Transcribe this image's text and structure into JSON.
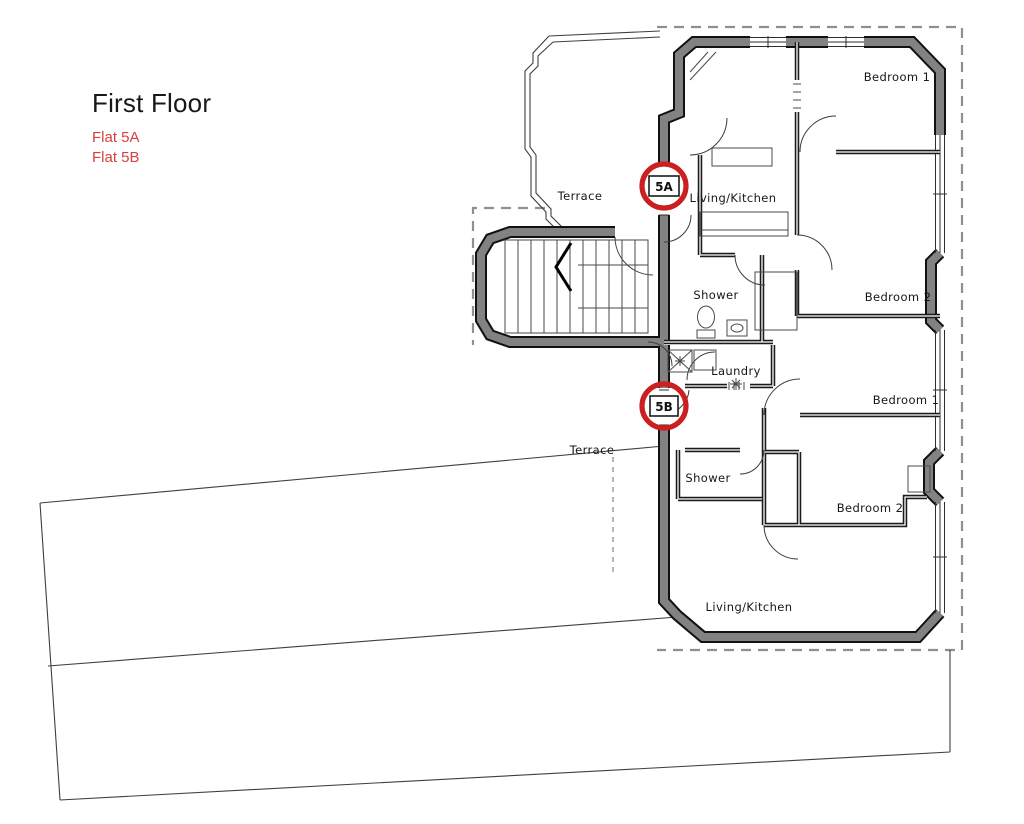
{
  "header": {
    "title": "First Floor",
    "flat_labels": [
      {
        "label": "Flat 5A"
      },
      {
        "label": "Flat 5B"
      }
    ]
  },
  "markers": [
    {
      "id": "5A",
      "label": "5A"
    },
    {
      "id": "5B",
      "label": "5B"
    }
  ],
  "rooms": [
    {
      "flat": "common",
      "label": "Terrace"
    },
    {
      "flat": "5A",
      "label": "Living/Kitchen"
    },
    {
      "flat": "5A",
      "label": "Bedroom 1"
    },
    {
      "flat": "5A",
      "label": "Bedroom 2"
    },
    {
      "flat": "5A",
      "label": "Shower"
    },
    {
      "flat": "5B",
      "label": "Laundry"
    },
    {
      "flat": "common",
      "label": "Terrace"
    },
    {
      "flat": "5B",
      "label": "Shower"
    },
    {
      "flat": "5B",
      "label": "Bedroom 1"
    },
    {
      "flat": "5B",
      "label": "Bedroom 2"
    },
    {
      "flat": "5B",
      "label": "Living/Kitchen"
    }
  ],
  "colors": {
    "flat_label_red": "#d6403e",
    "marker_circle_red": "#cc1f1f",
    "wall_gray": "#828282",
    "wall_outline": "#111111",
    "background": "#ffffff"
  }
}
